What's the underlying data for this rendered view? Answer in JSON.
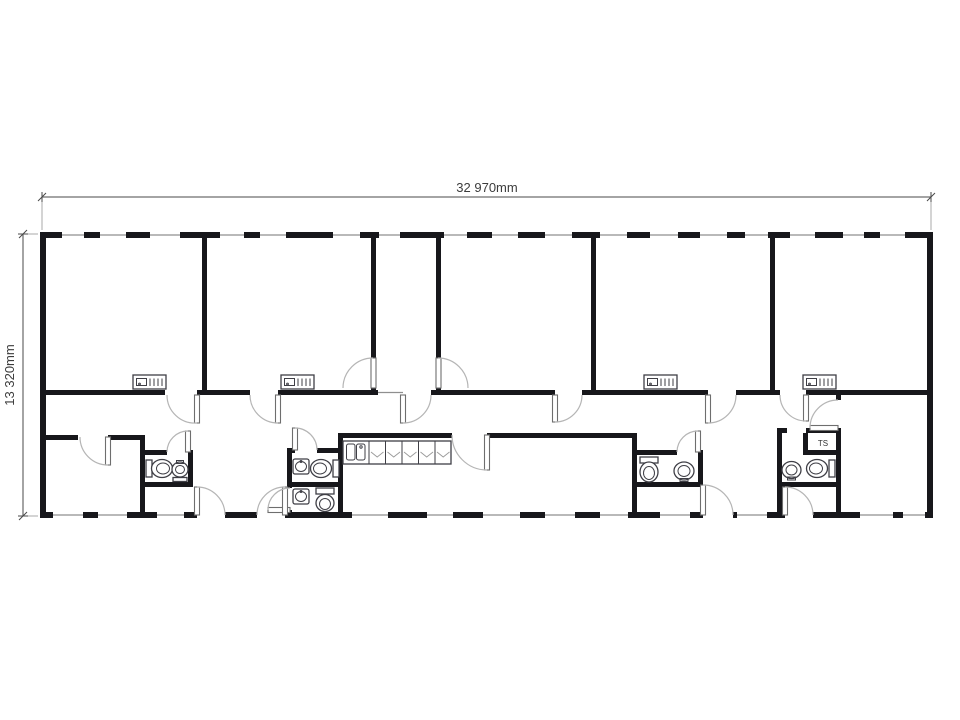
{
  "floor_plan": {
    "dimension_width_label": "32 970mm",
    "dimension_height_label": "13 320mm",
    "room_label_ts": "TS",
    "colors": {
      "wall": "#17171b",
      "door_arc": "#b5b5b5",
      "fixture_stroke": "#3f3f46",
      "dimension_text": "#3c3c3c"
    },
    "icons": {
      "toilet": "toilet-fixture",
      "sink": "sink-fixture",
      "radiator": "radiator-fixture",
      "kitchen_counter": "kitchen-counter-fixture",
      "door": "door-swing-arc",
      "window": "window-opening"
    }
  }
}
